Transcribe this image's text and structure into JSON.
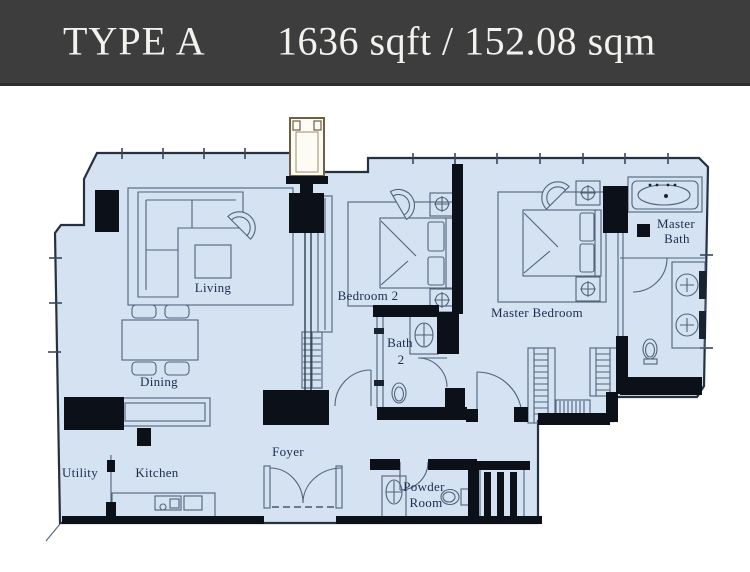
{
  "header": {
    "type_label": "TYPE A",
    "area_label": "1636 sqft / 152.08 sqm"
  },
  "plan": {
    "colors": {
      "header_bg": "#3d3d3e",
      "header_text": "#f4f2ee",
      "floor_fill": "#d4e2f1",
      "wall": "#0c1018",
      "line": "#51647c",
      "label_text": "#1d2c4e",
      "flue_fill": "#fdfbf3"
    },
    "rooms": {
      "living": {
        "label": "Living"
      },
      "dining": {
        "label": "Dining"
      },
      "kitchen": {
        "label": "Kitchen"
      },
      "utility": {
        "label": "Utility"
      },
      "foyer": {
        "label": "Foyer"
      },
      "bedroom2": {
        "label": "Bedroom 2"
      },
      "bath2": {
        "line1": "Bath",
        "line2": "2"
      },
      "master_bedroom": {
        "label": "Master Bedroom"
      },
      "master_bath": {
        "line1": "Master",
        "line2": "Bath"
      },
      "powder_room": {
        "line1": "Powder",
        "line2": "Room"
      }
    }
  }
}
